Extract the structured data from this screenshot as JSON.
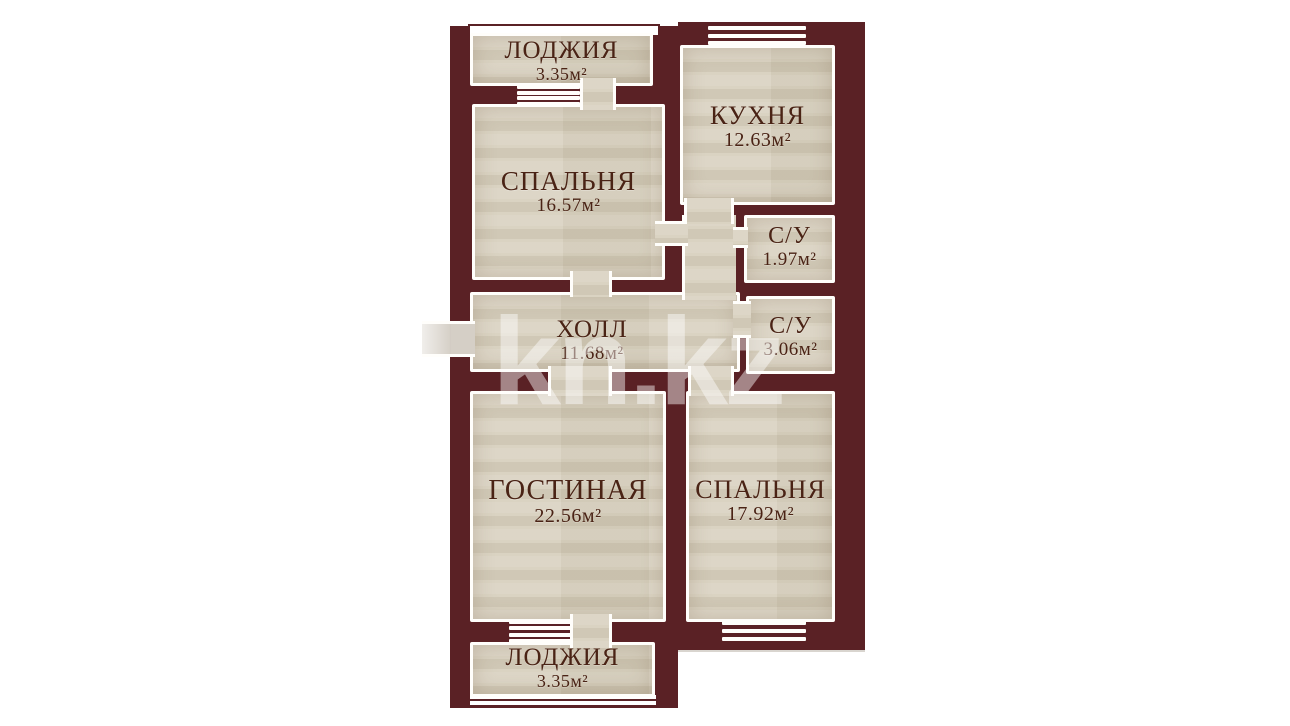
{
  "watermark": {
    "text": "kn.kz"
  },
  "rooms": [
    {
      "id": "loggia-top",
      "name": "ЛОДЖИЯ",
      "area": "3.35м²"
    },
    {
      "id": "bedroom-top",
      "name": "СПАЛЬНЯ",
      "area": "16.57м²"
    },
    {
      "id": "kitchen",
      "name": "КУХНЯ",
      "area": "12.63м²"
    },
    {
      "id": "bathroom-small",
      "name": "С/У",
      "area": "1.97м²"
    },
    {
      "id": "bathroom-large",
      "name": "С/У",
      "area": "3.06м²"
    },
    {
      "id": "hall",
      "name": "ХОЛЛ",
      "area": "11.68м²"
    },
    {
      "id": "living-room",
      "name": "ГОСТИНАЯ",
      "area": "22.56м²"
    },
    {
      "id": "bedroom-bottom",
      "name": "СПАЛЬНЯ",
      "area": "17.92м²"
    },
    {
      "id": "loggia-bottom",
      "name": "ЛОДЖИЯ",
      "area": "3.35м²"
    }
  ],
  "colors": {
    "wall": "#5a2125",
    "floor": "#d8d1bf",
    "outline": "#ffffff",
    "label_text": "#4a2315",
    "watermark": "#ffffff"
  }
}
